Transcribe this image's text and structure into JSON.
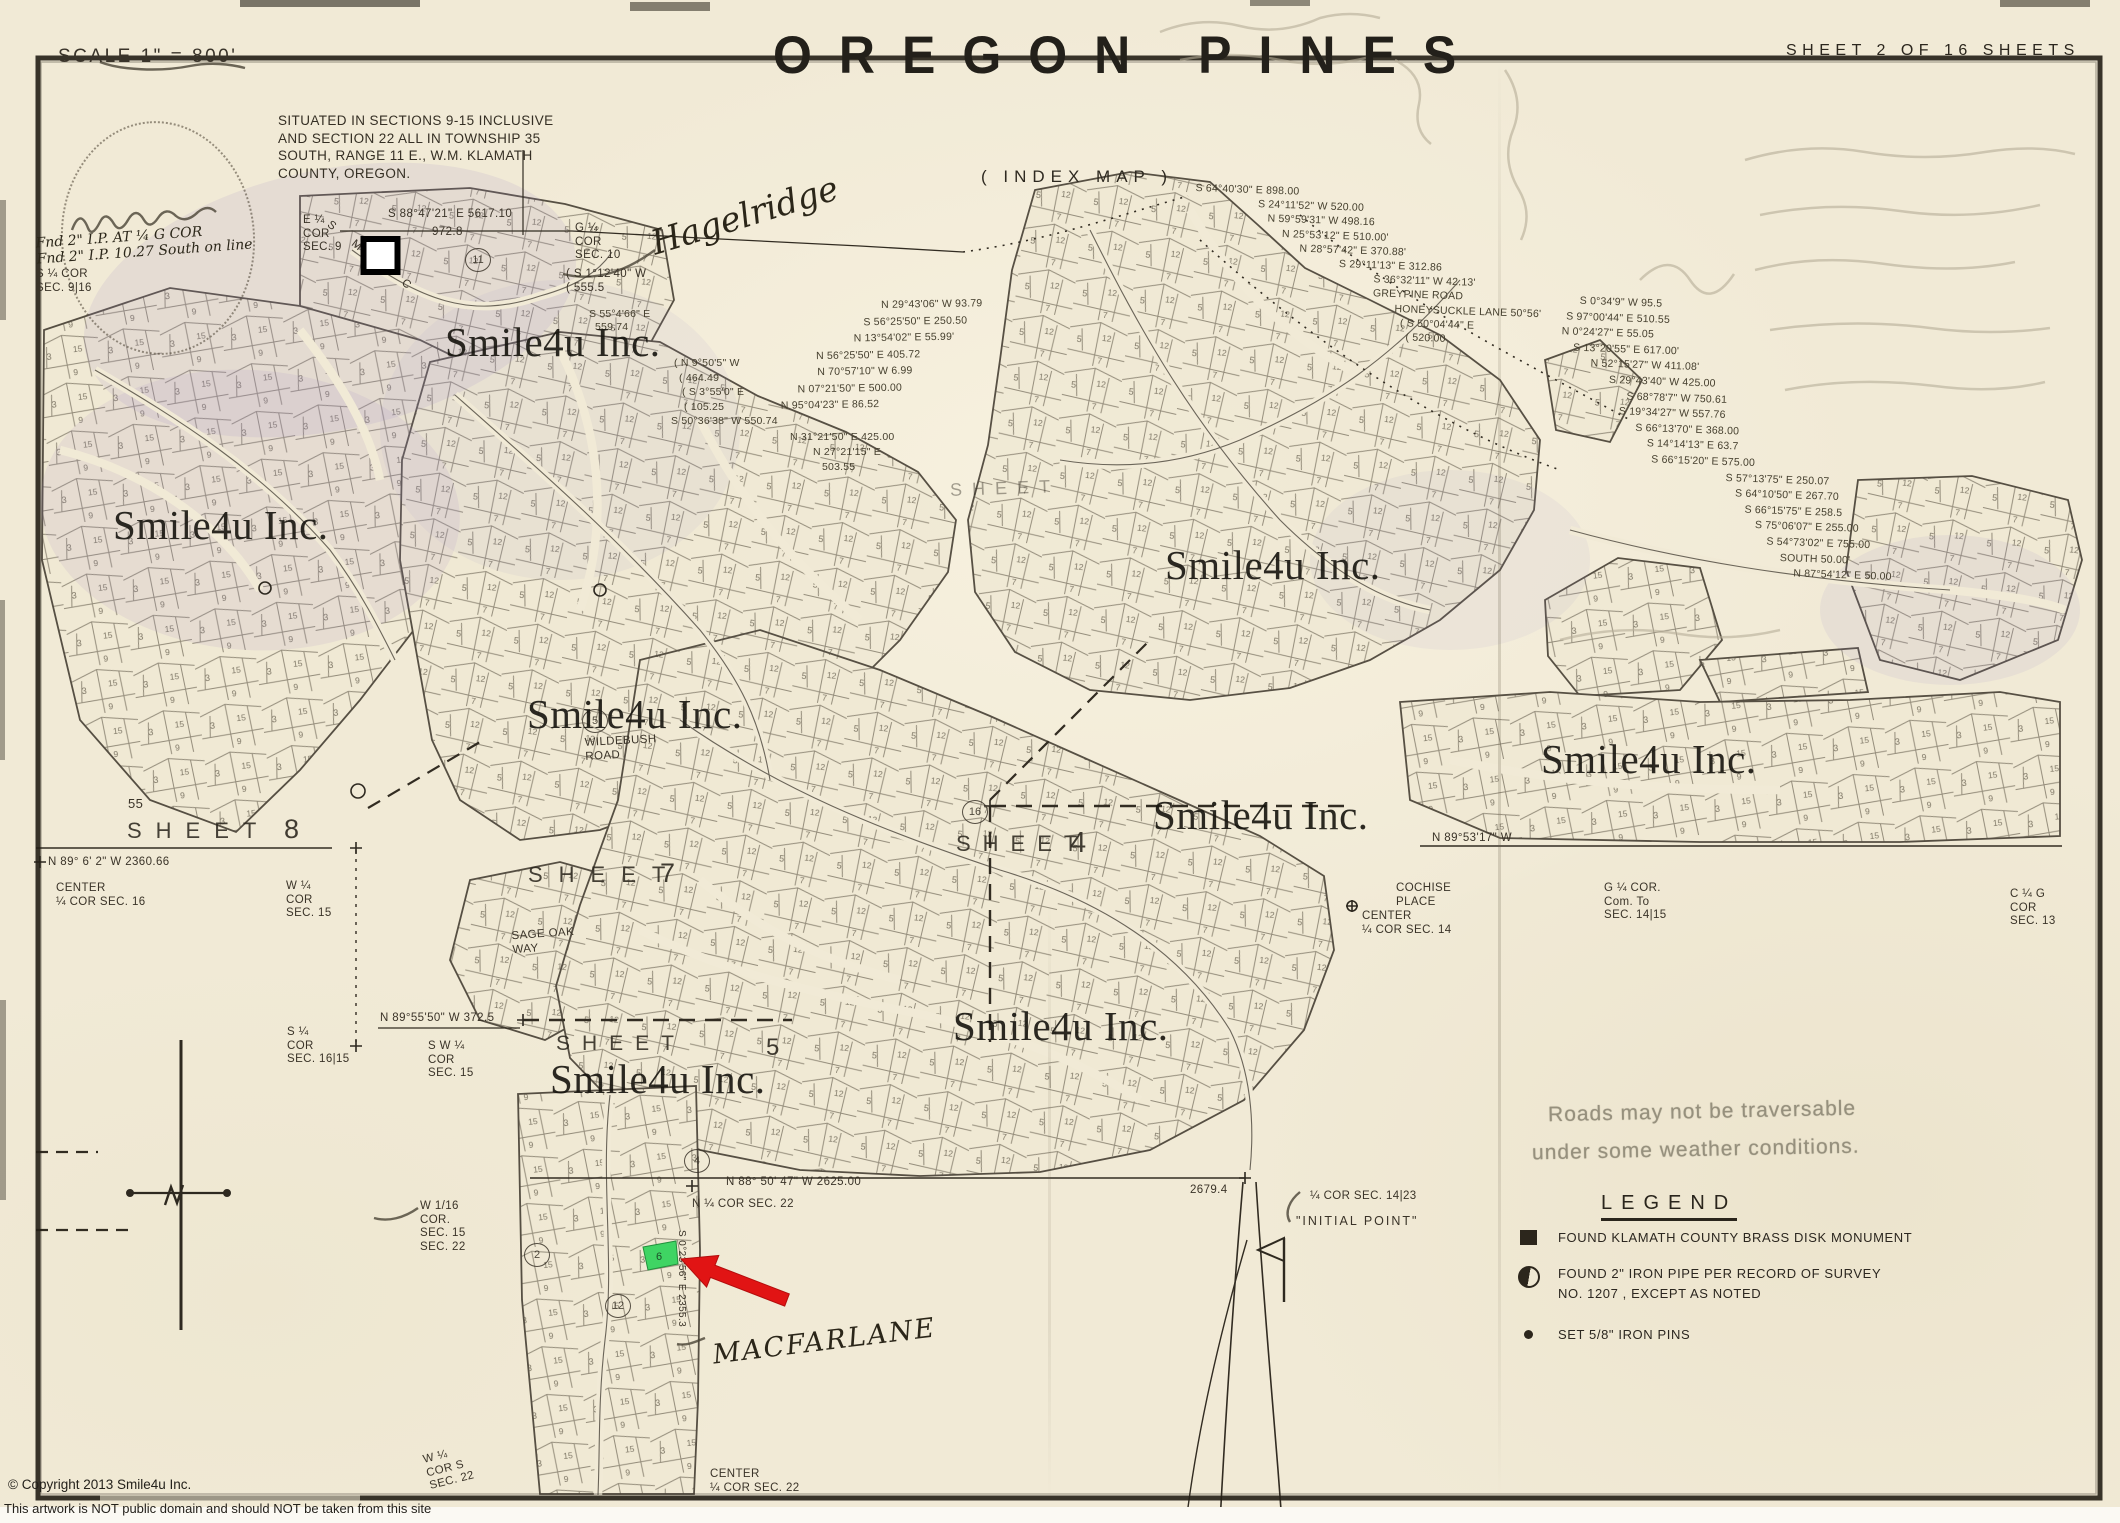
{
  "page": {
    "scale_label": "SCALE 1\" = 800'",
    "title": "OREGON PINES",
    "sheet_info": "SHEET 2 OF 16 SHEETS",
    "index_label": "( INDEX  MAP )",
    "situated_lines": "SITUATED IN SECTIONS 9-15 INCLUSIVE\nAND SECTION 22 ALL IN TOWNSHIP 35\nSOUTH, RANGE 11 E., W.M.  KLAMATH\nCOUNTY, OREGON.",
    "copyright_line1": "© Copyright 2013 Smile4u Inc.",
    "copyright_line2": "This artwork is NOT public domain and should NOT be taken from this site"
  },
  "watermark": {
    "text": "Smile4u Inc.",
    "instances": [
      {
        "x": 445,
        "y": 318
      },
      {
        "x": 113,
        "y": 501
      },
      {
        "x": 527,
        "y": 690
      },
      {
        "x": 1165,
        "y": 541
      },
      {
        "x": 1541,
        "y": 735
      },
      {
        "x": 1153,
        "y": 791
      },
      {
        "x": 953,
        "y": 1002
      },
      {
        "x": 550,
        "y": 1055
      }
    ]
  },
  "handwriting": {
    "hagelridge": "Hagelridge",
    "macfarlane": "MACFARLANE",
    "smec": "S M E C"
  },
  "sheet_labels": {
    "word": "SHEET",
    "s8_num": "8",
    "s8_township": "55",
    "s7_num": "7",
    "s4_num": "4",
    "s5_num": "5"
  },
  "legend": {
    "note_line1": "Roads may not be traversable",
    "note_line2": "under some weather conditions.",
    "title": "LEGEND",
    "item1": "FOUND KLAMATH COUNTY BRASS DISK MONUMENT",
    "item2a": "FOUND 2\" IRON PIPE PER RECORD OF SURVEY",
    "item2b": "NO. 1207 , EXCEPT AS NOTED",
    "item3": "SET  5/8\" IRON PINS"
  },
  "notes": {
    "e_cor_sec9": "E ¼\nCOR\nSEC. 9",
    "top_bearing": "S 88°47'21\" E      5617.10",
    "dist_972": "972.8",
    "g_cor_sec10": "G ¼\nCOR\nSEC. 10",
    "s1_1240": "( S 1°12'40\" W\n( 555.5",
    "fnd_note": "Fnd 2\" I.P. AT ¼ G COR\nFnd 2\" I.P. 10.27 South on line",
    "s_cor_sec916": "S ¼ COR\nSEC. 9|16",
    "n89_2360": "N 89° 6' 2\" W         2360.66",
    "center_sec16": "CENTER\n¼ COR SEC. 16",
    "w_cor_sec15": "W ¼\nCOR\nSEC. 15",
    "s_cor_sec1615": "S ¼\nCOR\nSEC. 16|15",
    "sw_cor_sec15": "S W ¼\nCOR\nSEC. 15",
    "n8955": "N 89°55'50\" W  372.5",
    "w16_cor": "W 1/16\nCOR.\nSEC. 15\nSEC. 22",
    "n_cor_sec22": "N ¼ COR SEC. 22",
    "n8850": "N 88° 50' 47\" W     2625.00",
    "dist_2679": "2679.4",
    "cor_sec1423": "¼ COR SEC. 14|23",
    "initial_point": "\"INITIAL POINT\"",
    "center_sec14": "CENTER\n¼ COR SEC. 14",
    "cochise": "COCHISE\nPLACE",
    "g_cor_com": "G ¼ COR.\nCom. To\nSEC. 14|15",
    "c_cor_sec13": "C ¼ G\nCOR\nSEC. 13",
    "n8953": "N 89°53'17\" W",
    "sage_oak": "SAGE OAK\nWAY",
    "wildebush": "WILDEBUSH\nROAD",
    "center_sec22": "CENTER\n¼ COR SEC. 22",
    "w_cor_sec22": "W ¼\nCOR S\nSEC. 22",
    "v_column": "S 0°23'56\" E   2355.3"
  },
  "bearings": {
    "group_a": [
      {
        "t": "N 29°43'06\" W  93.79",
        "dx": 102
      },
      {
        "t": "S 56°25'50\" E  250.50",
        "dx": 84
      },
      {
        "t": "N 13°54'02\" E  55.99'",
        "dx": 74
      },
      {
        "t": "N 56°25'50\" E  405.72",
        "dx": 36
      },
      {
        "t": "N 70°57'10\" W  6.99",
        "dx": 37
      },
      {
        "t": "N 07°21'50\" E  500.00",
        "dx": 17
      },
      {
        "t": "N 95°04'23\" E  86.52",
        "dx": 0
      }
    ],
    "group_a2": [
      {
        "t": "N 31°21'50\" E  425.00",
        "dx": 2
      },
      {
        "t": "N 27°21'15\" E",
        "dx": 25
      },
      {
        "t": "503.55",
        "dx": 34
      }
    ],
    "group_b": [
      {
        "t": "( N 9°50'5\" W",
        "dx": 3
      },
      {
        "t": "( 464.49",
        "dx": 8
      },
      {
        "t": "( S 3°55'0\" E",
        "dx": 11
      },
      {
        "t": "( 105.25",
        "dx": 13
      },
      {
        "t": "S 50°36'38\" W  550.74",
        "dx": 0
      }
    ],
    "group_left_pair": [
      {
        "t": "S 55°4'66\" E",
        "dx": 0
      },
      {
        "t": "559.74",
        "dx": 6
      }
    ],
    "group_c": [
      {
        "t": "S 64°40'30\" E  898.00",
        "dx": 3
      },
      {
        "t": "S 24°11'52\" W  520.00",
        "dx": 66
      },
      {
        "t": "N 59°59'31\" W  498.16",
        "dx": 76
      },
      {
        "t": "N 25°53'12\" E  510.00'",
        "dx": 91
      },
      {
        "t": "N 28°57'42\" E  370.88'",
        "dx": 109
      },
      {
        "t": "S 29°11'13\" E  312.86",
        "dx": 149
      },
      {
        "t": "S 36°32'11\" W  42.13'",
        "dx": 184
      },
      {
        "t": "GREYPINE ROAD",
        "dx": 184
      },
      {
        "t": "HONEYSUCKLE LANE  50°56'",
        "dx": 206
      },
      {
        "t": "( S 50°04'44\" E",
        "dx": 212
      },
      {
        "t": "( 520.00",
        "dx": 218
      }
    ],
    "group_d": [
      {
        "t": "S 0°34'9\" W  95.5",
        "dx": 19
      },
      {
        "t": "S 97°00'44\" E  510.55",
        "dx": 6
      },
      {
        "t": "N 0°24'27\" E  55.05",
        "dx": 2
      },
      {
        "t": "S 13°20'55\" E  617.00'",
        "dx": 14
      },
      {
        "t": "N 52°15'27\" W  411.08'",
        "dx": 32
      },
      {
        "t": "S 29°43'40\" W  425.00",
        "dx": 51
      },
      {
        "t": "S 68°78'7\" W  750.61",
        "dx": 69
      },
      {
        "t": "S 19°34'27\" W  557.76",
        "dx": 62
      },
      {
        "t": "S 66°13'70\" E  368.00",
        "dx": 79
      },
      {
        "t": "S 14°14'13\" E  63.7",
        "dx": 91
      },
      {
        "t": "S 66°15'20\" E  575.00",
        "dx": 96
      },
      {
        "t": "S 57°13'75\" E  250.07",
        "dx": 171
      },
      {
        "t": "S 64°10'50\" E  267.70",
        "dx": 181
      },
      {
        "t": "S 66°15'75\" E  258.5",
        "dx": 191
      },
      {
        "t": "S 75°06'07\" E  255.00",
        "dx": 202
      },
      {
        "t": "S 54°73'02\" E  755.00",
        "dx": 214
      },
      {
        "t": "SOUTH  50.00'",
        "dx": 228
      },
      {
        "t": "N 87°54'12\" E  50.00",
        "dx": 242
      }
    ]
  },
  "markers": {
    "circled": [
      {
        "n": "11",
        "x": 478,
        "y": 260
      },
      {
        "n": "5",
        "x": 595,
        "y": 721
      },
      {
        "n": "16",
        "x": 975,
        "y": 812
      },
      {
        "n": "4",
        "x": 697,
        "y": 1161
      },
      {
        "n": "2",
        "x": 537,
        "y": 1255
      },
      {
        "n": "12",
        "x": 618,
        "y": 1306
      }
    ]
  },
  "highlight": {
    "lot_number": "6"
  },
  "colors": {
    "paper": "#f1ead6",
    "ink": "#383123",
    "highlight_green": "#3fd463",
    "arrow_red": "#e11414"
  }
}
